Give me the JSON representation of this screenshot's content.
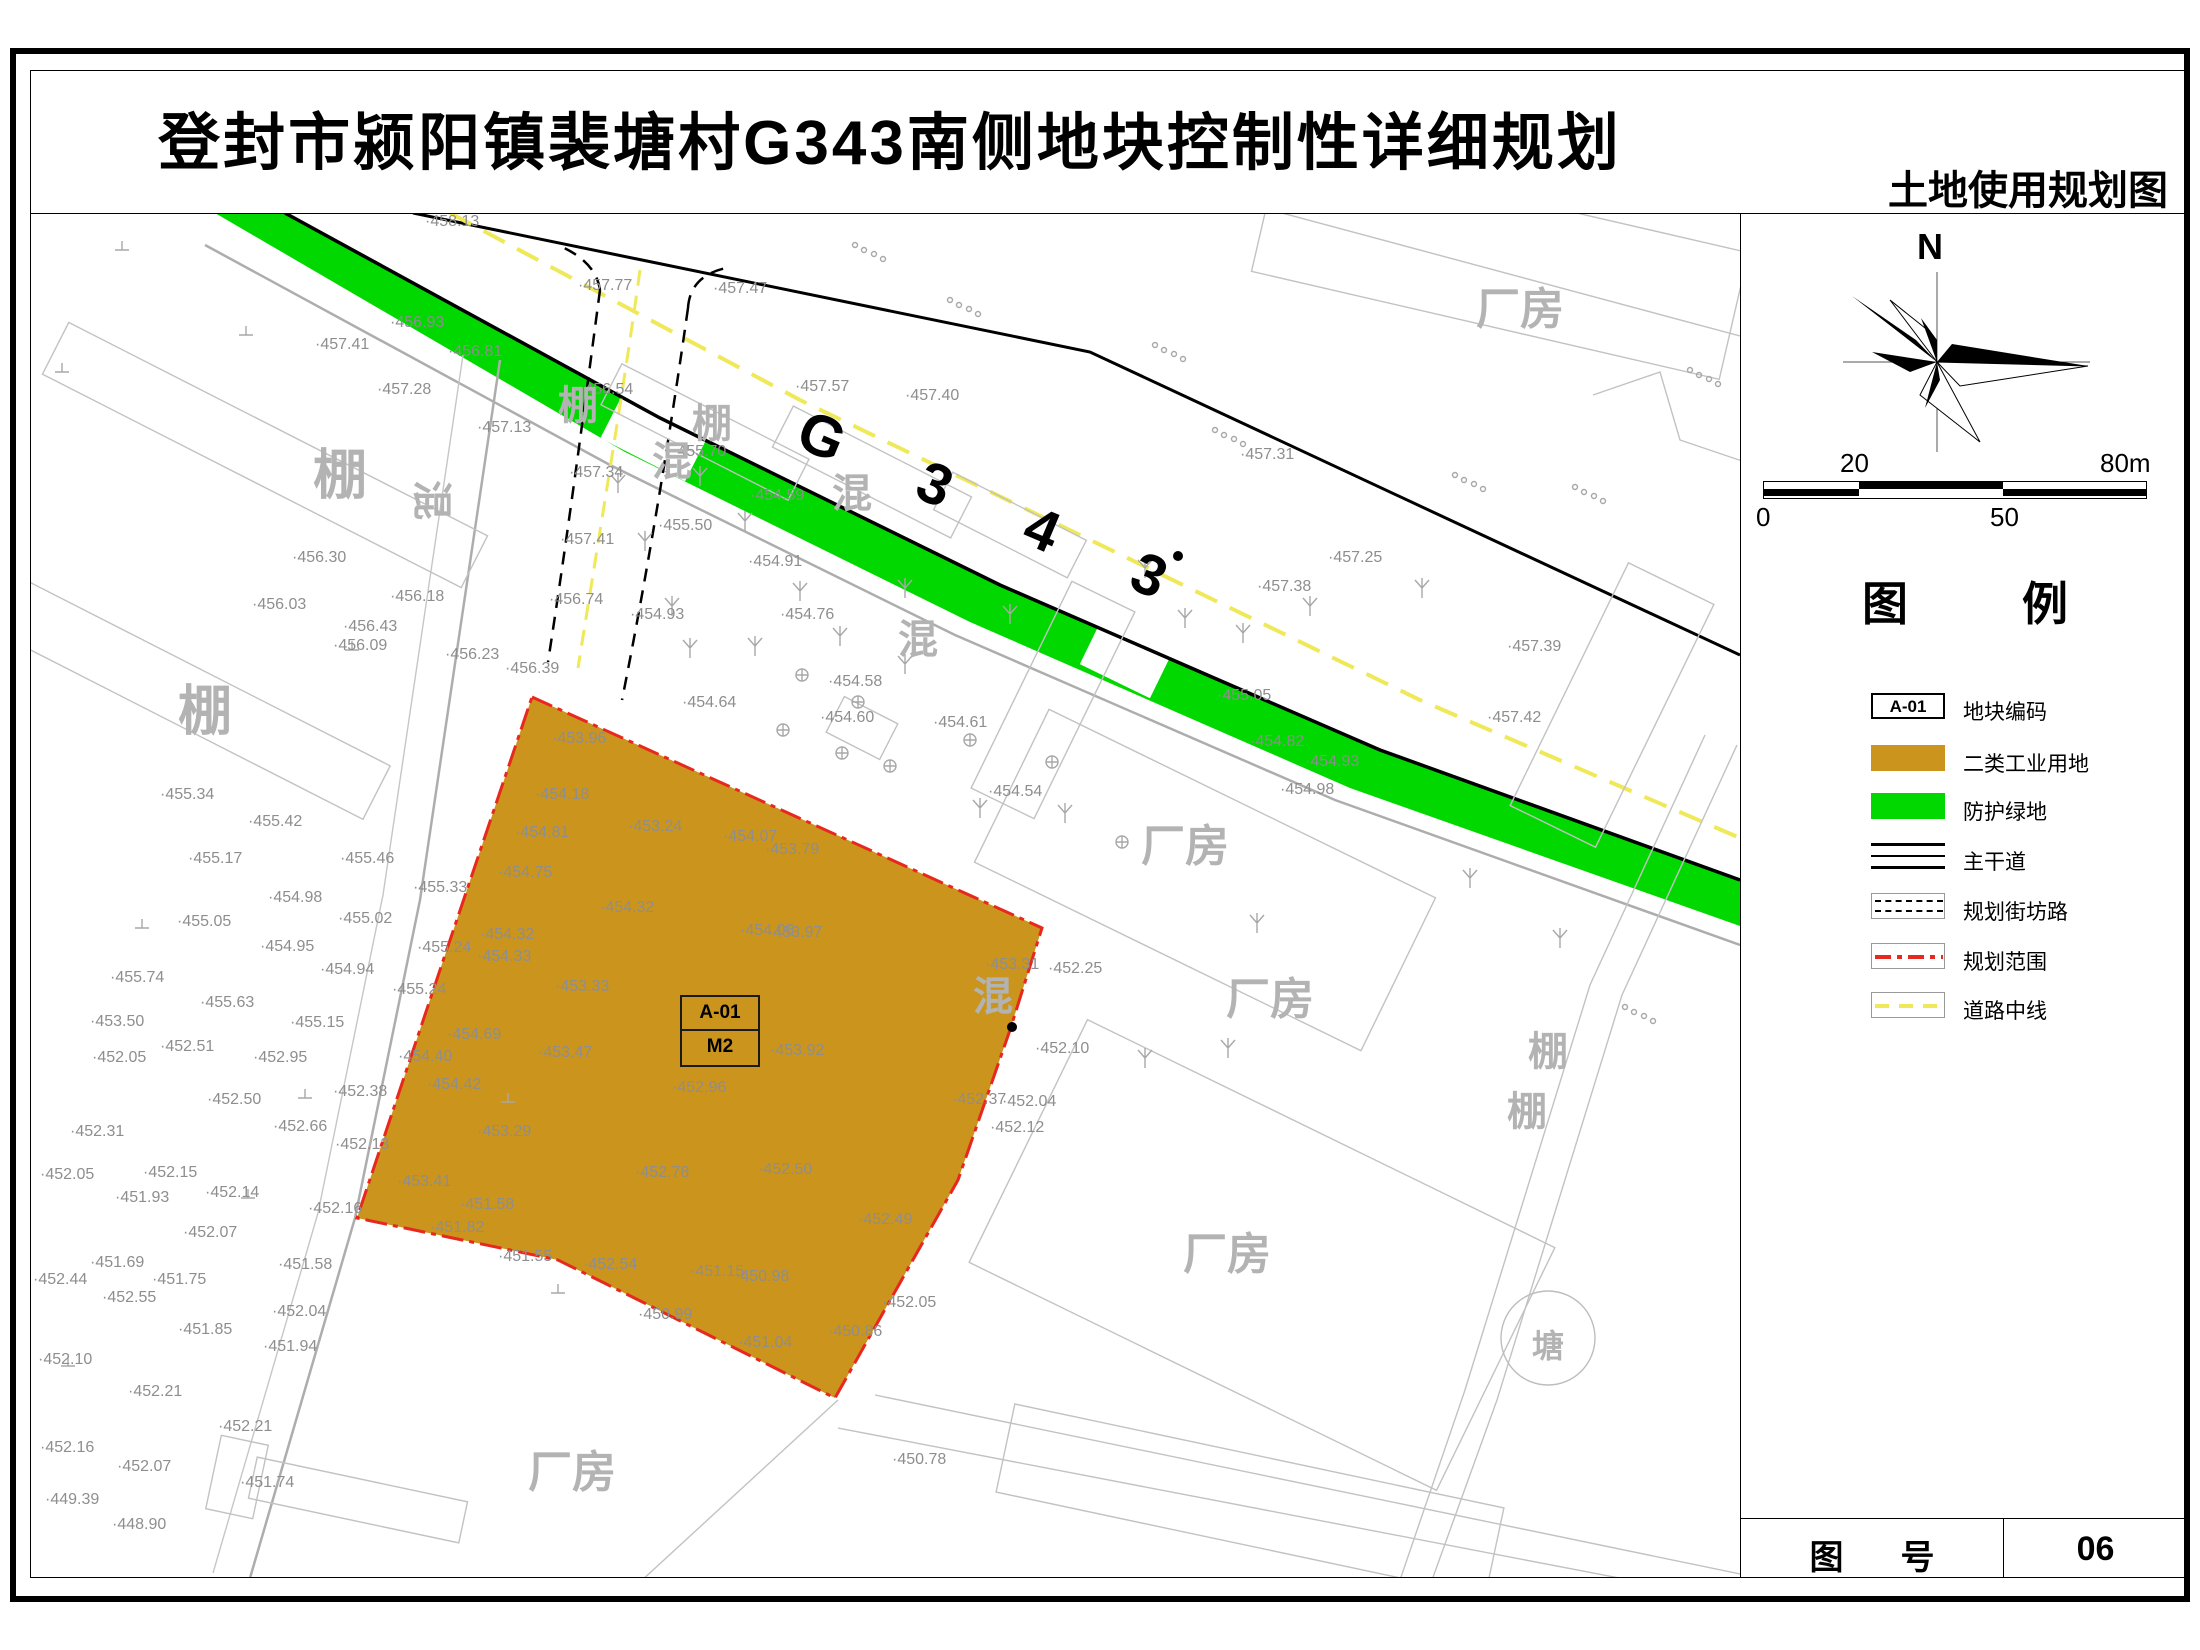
{
  "title": "登封市颍阳镇裴塘村G343南侧地块控制性详细规划",
  "subtitle": "土地使用规划图",
  "road": {
    "label": "G 3 4 3"
  },
  "plot": {
    "code": "A-01",
    "zone": "M2"
  },
  "north": {
    "label": "N"
  },
  "scale_bar": {
    "top_left": "20",
    "top_right": "80m",
    "bottom_left": "0",
    "bottom_mid": "50"
  },
  "legend": {
    "title": "图 例",
    "items": [
      {
        "label": "地块编码",
        "code": "A-01"
      },
      {
        "label": "二类工业用地"
      },
      {
        "label": "防护绿地"
      },
      {
        "label": "主干道"
      },
      {
        "label": "规划街坊路"
      },
      {
        "label": "规划范围"
      },
      {
        "label": "道路中线"
      }
    ]
  },
  "sheet": {
    "label": "图 号",
    "number": "06"
  },
  "colors": {
    "industrial": "#CB941C",
    "green_buffer": "#00D800",
    "boundary_red": "#E8281E",
    "centerline_yellow": "#EFE95A"
  },
  "pond": {
    "label": "塘",
    "cx": 1548,
    "cy": 1338,
    "r": 47
  },
  "area_labels": [
    {
      "t": "棚",
      "x": 340,
      "y": 470,
      "s": 54
    },
    {
      "t": "棚",
      "x": 205,
      "y": 706,
      "s": 54
    },
    {
      "t": "棚",
      "x": 578,
      "y": 402,
      "s": 40
    },
    {
      "t": "棚",
      "x": 712,
      "y": 420,
      "s": 40
    },
    {
      "t": "混",
      "x": 672,
      "y": 458,
      "s": 40
    },
    {
      "t": "混",
      "x": 852,
      "y": 490,
      "s": 40
    },
    {
      "t": "混",
      "x": 435,
      "y": 500,
      "s": 40,
      "r": 90
    },
    {
      "t": "混",
      "x": 993,
      "y": 993,
      "s": 40
    },
    {
      "t": "混",
      "x": 918,
      "y": 636,
      "s": 40
    },
    {
      "t": "棚",
      "x": 1548,
      "y": 1048,
      "s": 40
    },
    {
      "t": "棚",
      "x": 1527,
      "y": 1108,
      "s": 40
    },
    {
      "t": "厂房",
      "x": 1520,
      "y": 305,
      "s": 44
    },
    {
      "t": "厂房",
      "x": 1185,
      "y": 842,
      "s": 44
    },
    {
      "t": "厂房",
      "x": 1270,
      "y": 995,
      "s": 44
    },
    {
      "t": "厂房",
      "x": 1227,
      "y": 1250,
      "s": 44
    },
    {
      "t": "厂房",
      "x": 572,
      "y": 1468,
      "s": 44
    },
    {
      "t": "塘",
      "x": 1548,
      "y": 1344,
      "s": 32
    }
  ],
  "spot_elevations": [
    [
      425,
      222,
      "458.13"
    ],
    [
      578,
      286,
      "457.77"
    ],
    [
      713,
      289,
      "457.47"
    ],
    [
      390,
      323,
      "456.93"
    ],
    [
      315,
      345,
      "457.41"
    ],
    [
      448,
      352,
      "456.81"
    ],
    [
      377,
      390,
      "457.28"
    ],
    [
      477,
      428,
      "457.13"
    ],
    [
      579,
      390,
      "456.54"
    ],
    [
      795,
      387,
      "457.57"
    ],
    [
      905,
      396,
      "457.40"
    ],
    [
      1240,
      455,
      "457.31"
    ],
    [
      1328,
      558,
      "457.25"
    ],
    [
      1257,
      587,
      "457.38"
    ],
    [
      1507,
      647,
      "457.39"
    ],
    [
      1487,
      718,
      "457.42"
    ],
    [
      672,
      452,
      "455.70"
    ],
    [
      569,
      473,
      "457.34"
    ],
    [
      560,
      540,
      "457.41"
    ],
    [
      658,
      526,
      "455.50"
    ],
    [
      630,
      615,
      "454.93"
    ],
    [
      748,
      562,
      "454.91"
    ],
    [
      780,
      615,
      "454.76"
    ],
    [
      750,
      496,
      "454.59"
    ],
    [
      292,
      558,
      "456.30"
    ],
    [
      252,
      605,
      "456.03"
    ],
    [
      390,
      597,
      "456.18"
    ],
    [
      549,
      600,
      "456.74"
    ],
    [
      343,
      627,
      "456.43"
    ],
    [
      333,
      646,
      "456.09"
    ],
    [
      445,
      655,
      "456.23"
    ],
    [
      505,
      669,
      "456.39"
    ],
    [
      682,
      703,
      "454.64"
    ],
    [
      828,
      682,
      "454.58"
    ],
    [
      820,
      718,
      "454.60"
    ],
    [
      933,
      723,
      "454.61"
    ],
    [
      988,
      792,
      "454.54"
    ],
    [
      1217,
      696,
      "455.05"
    ],
    [
      1250,
      742,
      "454.82"
    ],
    [
      1305,
      762,
      "454.93"
    ],
    [
      1280,
      790,
      "454.98"
    ],
    [
      552,
      739,
      "453.96"
    ],
    [
      535,
      795,
      "454.18"
    ],
    [
      628,
      827,
      "453.24"
    ],
    [
      515,
      833,
      "454.81"
    ],
    [
      723,
      837,
      "454.07"
    ],
    [
      765,
      850,
      "453.79"
    ],
    [
      498,
      873,
      "454.75"
    ],
    [
      600,
      908,
      "454.32"
    ],
    [
      740,
      931,
      "454.06"
    ],
    [
      768,
      933,
      "453.97"
    ],
    [
      480,
      935,
      "454.32"
    ],
    [
      477,
      957,
      "454.33"
    ],
    [
      555,
      987,
      "453.33"
    ],
    [
      447,
      1035,
      "454.69"
    ],
    [
      538,
      1053,
      "453.47"
    ],
    [
      770,
      1051,
      "453.92"
    ],
    [
      672,
      1088,
      "452.96"
    ],
    [
      427,
      1085,
      "454.42"
    ],
    [
      477,
      1132,
      "453.29"
    ],
    [
      397,
      1182,
      "453.41"
    ],
    [
      460,
      1205,
      "451.58"
    ],
    [
      430,
      1228,
      "451.82"
    ],
    [
      498,
      1257,
      "451.55"
    ],
    [
      635,
      1173,
      "452.78"
    ],
    [
      758,
      1170,
      "452.50"
    ],
    [
      583,
      1265,
      "452.54"
    ],
    [
      690,
      1272,
      "451.15"
    ],
    [
      735,
      1277,
      "450.98"
    ],
    [
      858,
      1220,
      "452.49"
    ],
    [
      638,
      1315,
      "450.99"
    ],
    [
      738,
      1343,
      "451.04"
    ],
    [
      882,
      1303,
      "452.05"
    ],
    [
      828,
      1332,
      "450.86"
    ],
    [
      160,
      795,
      "455.34"
    ],
    [
      248,
      822,
      "455.42"
    ],
    [
      188,
      859,
      "455.17"
    ],
    [
      340,
      859,
      "455.46"
    ],
    [
      413,
      888,
      "455.33"
    ],
    [
      268,
      898,
      "454.98"
    ],
    [
      177,
      922,
      "455.05"
    ],
    [
      338,
      919,
      "455.02"
    ],
    [
      260,
      947,
      "454.95"
    ],
    [
      320,
      970,
      "454.94"
    ],
    [
      417,
      948,
      "455.24"
    ],
    [
      392,
      990,
      "455.24"
    ],
    [
      110,
      978,
      "455.74"
    ],
    [
      200,
      1003,
      "455.63"
    ],
    [
      90,
      1022,
      "453.50"
    ],
    [
      290,
      1023,
      "455.15"
    ],
    [
      160,
      1047,
      "452.51"
    ],
    [
      92,
      1058,
      "452.05"
    ],
    [
      253,
      1058,
      "452.95"
    ],
    [
      398,
      1057,
      "454.40"
    ],
    [
      207,
      1100,
      "452.50"
    ],
    [
      70,
      1132,
      "452.31"
    ],
    [
      273,
      1127,
      "452.66"
    ],
    [
      333,
      1092,
      "452.38"
    ],
    [
      335,
      1145,
      "452.13"
    ],
    [
      40,
      1175,
      "452.05"
    ],
    [
      143,
      1173,
      "452.15"
    ],
    [
      115,
      1198,
      "451.93"
    ],
    [
      205,
      1193,
      "452.14"
    ],
    [
      308,
      1209,
      "452.16"
    ],
    [
      183,
      1233,
      "452.07"
    ],
    [
      90,
      1263,
      "451.69"
    ],
    [
      152,
      1280,
      "451.75"
    ],
    [
      278,
      1265,
      "451.58"
    ],
    [
      33,
      1280,
      "452.44"
    ],
    [
      102,
      1298,
      "452.55"
    ],
    [
      272,
      1312,
      "452.04"
    ],
    [
      178,
      1330,
      "451.85"
    ],
    [
      263,
      1347,
      "451.94"
    ],
    [
      38,
      1360,
      "452.10"
    ],
    [
      128,
      1392,
      "452.21"
    ],
    [
      218,
      1427,
      "452.21"
    ],
    [
      40,
      1448,
      "452.16"
    ],
    [
      117,
      1467,
      "452.07"
    ],
    [
      45,
      1500,
      "449.39"
    ],
    [
      112,
      1525,
      "448.90"
    ],
    [
      240,
      1483,
      "451.74"
    ],
    [
      985,
      965,
      "453.31"
    ],
    [
      1048,
      969,
      "452.25"
    ],
    [
      1035,
      1049,
      "452.10"
    ],
    [
      952,
      1100,
      "452.37"
    ],
    [
      1002,
      1102,
      "452.04"
    ],
    [
      990,
      1128,
      "452.12"
    ],
    [
      892,
      1460,
      "450.78"
    ]
  ],
  "map_symbols": {
    "trees": [
      [
        618,
        487
      ],
      [
        645,
        545
      ],
      [
        700,
        480
      ],
      [
        745,
        525
      ],
      [
        672,
        610
      ],
      [
        800,
        595
      ],
      [
        690,
        652
      ],
      [
        755,
        650
      ],
      [
        905,
        592
      ],
      [
        1010,
        618
      ],
      [
        1145,
        572
      ],
      [
        1185,
        622
      ],
      [
        1243,
        637
      ],
      [
        1310,
        610
      ],
      [
        1422,
        592
      ],
      [
        980,
        812
      ],
      [
        1065,
        817
      ],
      [
        1257,
        927
      ],
      [
        1470,
        882
      ],
      [
        1560,
        942
      ],
      [
        1145,
        1062
      ],
      [
        1228,
        1052
      ],
      [
        905,
        668
      ],
      [
        840,
        640
      ]
    ],
    "circled_plus": [
      [
        802,
        675
      ],
      [
        858,
        702
      ],
      [
        783,
        730
      ],
      [
        842,
        753
      ],
      [
        890,
        766
      ],
      [
        970,
        740
      ],
      [
        1052,
        762
      ],
      [
        1122,
        842
      ]
    ],
    "ground_marks": [
      [
        122,
        250
      ],
      [
        246,
        335
      ],
      [
        62,
        372
      ],
      [
        352,
        650
      ],
      [
        142,
        928
      ],
      [
        248,
        1198
      ],
      [
        558,
        1293
      ],
      [
        68,
        1366
      ],
      [
        305,
        1098
      ],
      [
        508,
        1102
      ]
    ],
    "stone_clusters": [
      [
        855,
        245
      ],
      [
        950,
        300
      ],
      [
        1155,
        345
      ],
      [
        1215,
        430
      ],
      [
        1455,
        475
      ],
      [
        1575,
        487
      ],
      [
        1625,
        1007
      ],
      [
        1690,
        370
      ]
    ],
    "dots": [
      [
        1178,
        556
      ],
      [
        1012,
        1027
      ]
    ]
  },
  "buildings": [
    [
      265,
      455,
      470,
      58,
      27
    ],
    [
      185,
      695,
      430,
      60,
      27
    ],
    [
      705,
      432,
      210,
      46,
      27
    ],
    [
      872,
      472,
      200,
      46,
      27
    ],
    [
      1010,
      525,
      150,
      42,
      27
    ],
    [
      862,
      728,
      60,
      40,
      27
    ],
    [
      1500,
      262,
      480,
      130,
      13
    ],
    [
      1205,
      880,
      430,
      170,
      26
    ],
    [
      1262,
      1255,
      520,
      270,
      26
    ],
    [
      1612,
      705,
      95,
      270,
      26
    ],
    [
      358,
      1500,
      215,
      42,
      12
    ],
    [
      237,
      1477,
      48,
      75,
      12
    ],
    [
      1053,
      700,
      70,
      230,
      26
    ],
    [
      1250,
      1500,
      500,
      90,
      12
    ]
  ]
}
